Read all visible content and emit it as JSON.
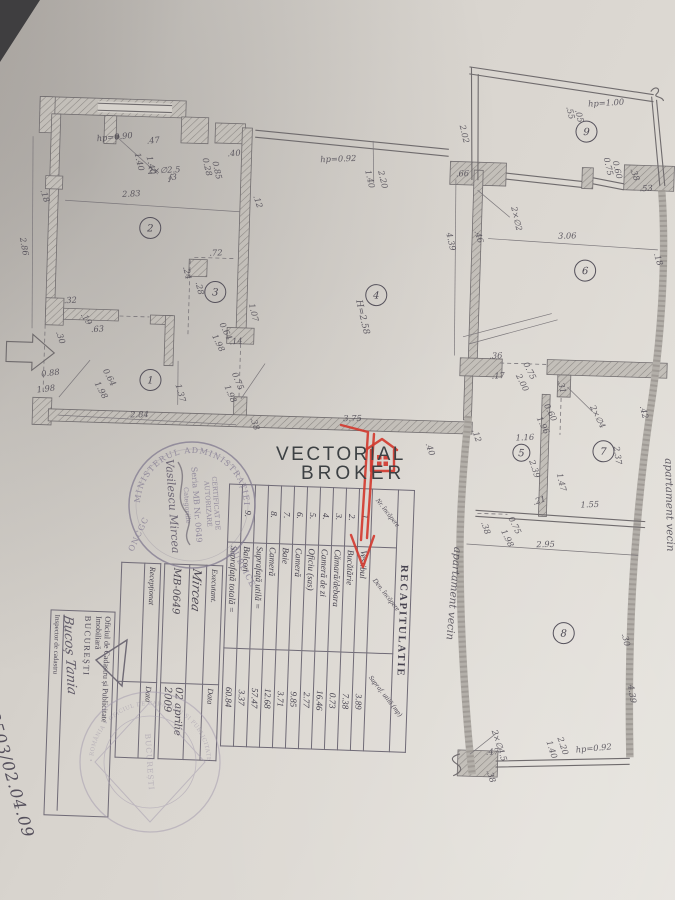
{
  "watermark": {
    "line1": "VECTORIAL",
    "line2": "BROKER"
  },
  "handwritten_number": "173503/02.04.09",
  "recapitulatie": {
    "title": "RECAPITULATIE",
    "col_nr": "Nr. încăpere",
    "col_den": "Den. încăpere",
    "col_supr": "Supraf. utilă (mp)",
    "rows": [
      {
        "nr": "1.",
        "name": "Vestibul",
        "val": "3.89"
      },
      {
        "nr": "2.",
        "name": "Bucătărie",
        "val": "7.38"
      },
      {
        "nr": "3.",
        "name": "Cămară/debara",
        "val": "0.73"
      },
      {
        "nr": "4.",
        "name": "Cameră de zi",
        "val": "16.46"
      },
      {
        "nr": "5.",
        "name": "Oficiu (sas)",
        "val": "2.77"
      },
      {
        "nr": "6.",
        "name": "Cameră",
        "val": "9.85"
      },
      {
        "nr": "7.",
        "name": "Baie",
        "val": "3.71"
      },
      {
        "nr": "8.",
        "name": "Cameră",
        "val": "12.68"
      },
      {
        "nr": "",
        "name": "Suprafață utilă =",
        "val": "57.47",
        "total": true
      },
      {
        "nr": "9.",
        "name": "Balcon",
        "val": "3.37"
      },
      {
        "nr": "",
        "name": "Suprafață totală =",
        "val": "60.84",
        "total": true
      }
    ]
  },
  "executant": {
    "label": "Executant.",
    "data_label": "Data",
    "signature": "Mircea",
    "value": "MB-0649",
    "date": "02 aprilie 2009",
    "receptionat_label": "Recepționat",
    "data_label2": "Data"
  },
  "oficiul": {
    "line1": "Oficiul de Cadastru și Publicitate",
    "line2": "Imobiliară",
    "city": "BUCUREȘTI",
    "inspector": "Inspector de cadastru",
    "signature": "Bucoș Tania"
  },
  "stamps": {
    "ministry": {
      "ring_top": "MINISTERUL ADMINISTRAȚIEI",
      "ring_right": "PUBLICE",
      "ring_left": "ONCGC",
      "line1": "CERTIFICAT DE",
      "line2": "AUTORIZARE",
      "line3": "Seria MB Nr. 0649",
      "line4": "Categoriile",
      "name": "Vasilescu Mircea"
    },
    "cadastru": {
      "ring": "• ROMÂNIA • OFICIUL DE CADASTRU ȘI PUBLICITATE IMOBILIARĂ •",
      "center": "BUCUREȘTI"
    }
  },
  "plan": {
    "labels": [
      {
        "t": ".47",
        "x": 138,
        "y": 150,
        "r": -8
      },
      {
        "t": "∮3",
        "x": 160,
        "y": 186,
        "r": -8
      },
      {
        "t": "hp=0.90",
        "x": 88,
        "y": 149,
        "r": -7
      },
      {
        "t": "1.40",
        "x": 126,
        "y": 160,
        "r": 75
      },
      {
        "t": "1.40",
        "x": 138,
        "y": 163,
        "r": 75
      },
      {
        "t": "2×∅2.5",
        "x": 140,
        "y": 180,
        "r": -5
      },
      {
        "t": "0.28",
        "x": 194,
        "y": 163,
        "r": 75
      },
      {
        "t": "0.85",
        "x": 204,
        "y": 166,
        "r": 75
      },
      {
        "t": ".40",
        "x": 219,
        "y": 160,
        "r": -5
      },
      {
        "t": "2.86",
        "x": 14,
        "y": 248,
        "r": 78
      },
      {
        "t": ".18",
        "x": 33,
        "y": 200,
        "r": 70
      },
      {
        "t": "2.83",
        "x": 115,
        "y": 204,
        "r": -5
      },
      {
        "t": ".12",
        "x": 246,
        "y": 199,
        "r": 70
      },
      {
        "t": ".72",
        "x": 204,
        "y": 260,
        "r": -4
      },
      {
        "t": ".24",
        "x": 178,
        "y": 272,
        "r": 75
      },
      {
        "t": ".28",
        "x": 191,
        "y": 287,
        "r": 75
      },
      {
        "t": "1.07",
        "x": 245,
        "y": 307,
        "r": 75
      },
      {
        "t": "0.64",
        "x": 216,
        "y": 328,
        "r": 62
      },
      {
        "t": "1.98",
        "x": 209,
        "y": 340,
        "r": 62
      },
      {
        "t": ".14",
        "x": 227,
        "y": 348,
        "r": -6
      },
      {
        "t": ".32",
        "x": 60,
        "y": 312,
        "r": -5
      },
      {
        "t": ".19",
        "x": 77,
        "y": 323,
        "r": 55
      },
      {
        "t": ".30",
        "x": 53,
        "y": 341,
        "r": 70
      },
      {
        "t": ".63",
        "x": 88,
        "y": 340,
        "r": -5
      },
      {
        "t": "0.64",
        "x": 101,
        "y": 378,
        "r": 60
      },
      {
        "t": "1.98",
        "x": 93,
        "y": 391,
        "r": 60
      },
      {
        "t": "0.88",
        "x": 40,
        "y": 386,
        "r": -8
      },
      {
        "t": "1.98",
        "x": 36,
        "y": 402,
        "r": -8
      },
      {
        "t": "1.37",
        "x": 174,
        "y": 390,
        "r": 72
      },
      {
        "t": "2.84",
        "x": 130,
        "y": 424,
        "r": -3
      },
      {
        "t": ".38",
        "x": 250,
        "y": 421,
        "r": 70
      },
      {
        "t": "0.75",
        "x": 230,
        "y": 377,
        "r": 65
      },
      {
        "t": "1.98",
        "x": 223,
        "y": 390,
        "r": 65
      },
      {
        "t": "3.75",
        "x": 343,
        "y": 421,
        "r": -2
      },
      {
        "t": ".40",
        "x": 426,
        "y": 441,
        "r": 70
      },
      {
        "t": ".12",
        "x": 472,
        "y": 426,
        "r": 70
      },
      {
        "t": "hp=0.92",
        "x": 312,
        "y": 163,
        "r": -4
      },
      {
        "t": "1.40",
        "x": 357,
        "y": 170,
        "r": 75
      },
      {
        "t": "2.20",
        "x": 370,
        "y": 170,
        "r": 75
      },
      {
        "t": ".66",
        "x": 448,
        "y": 173,
        "r": -4
      },
      {
        "t": "4.39",
        "x": 440,
        "y": 230,
        "r": 75
      },
      {
        "t": "H=2.58",
        "x": 352,
        "y": 300,
        "r": 75,
        "s": 9
      },
      {
        "t": "2.02",
        "x": 450,
        "y": 122,
        "r": 75
      },
      {
        "t": ".55",
        "x": 556,
        "y": 100,
        "r": 75
      },
      {
        "t": ".05",
        "x": 565,
        "y": 103,
        "r": 75
      },
      {
        "t": "hp=1.00",
        "x": 578,
        "y": 99,
        "r": -5
      },
      {
        "t": "0.75",
        "x": 595,
        "y": 150,
        "r": 75
      },
      {
        "t": "0.60",
        "x": 604,
        "y": 153,
        "r": 75
      },
      {
        "t": ".38",
        "x": 622,
        "y": 160,
        "r": 70
      },
      {
        "t": ".53",
        "x": 632,
        "y": 182,
        "r": -4
      },
      {
        "t": "2×∅2",
        "x": 504,
        "y": 202,
        "r": 75
      },
      {
        "t": ".46",
        "x": 468,
        "y": 227,
        "r": 70
      },
      {
        "t": "3.06",
        "x": 552,
        "y": 232,
        "r": -3
      },
      {
        "t": ".18",
        "x": 648,
        "y": 244,
        "r": 70
      },
      {
        "t": ".36",
        "x": 487,
        "y": 354,
        "r": -4
      },
      {
        "t": ".17",
        "x": 490,
        "y": 374,
        "r": -4
      },
      {
        "t": "0.75",
        "x": 521,
        "y": 358,
        "r": 62
      },
      {
        "t": "2.00",
        "x": 514,
        "y": 370,
        "r": 62
      },
      {
        "t": ".31",
        "x": 556,
        "y": 374,
        "r": 75
      },
      {
        "t": "0.60",
        "x": 543,
        "y": 399,
        "r": 62
      },
      {
        "t": "1.96",
        "x": 536,
        "y": 412,
        "r": 62
      },
      {
        "t": "2×∅4",
        "x": 589,
        "y": 399,
        "r": 62
      },
      {
        "t": ".42",
        "x": 639,
        "y": 397,
        "r": 75
      },
      {
        "t": "2.37",
        "x": 614,
        "y": 438,
        "r": 80
      },
      {
        "t": "1.16",
        "x": 516,
        "y": 435,
        "r": -4
      },
      {
        "t": "2.39",
        "x": 530,
        "y": 455,
        "r": 70
      },
      {
        "t": "1.47",
        "x": 558,
        "y": 467,
        "r": 75
      },
      {
        "t": "1.55",
        "x": 583,
        "y": 500,
        "r": -4
      },
      {
        "t": ".21",
        "x": 536,
        "y": 499,
        "r": -20
      },
      {
        "t": "0.75",
        "x": 511,
        "y": 513,
        "r": 62
      },
      {
        "t": "1.98",
        "x": 504,
        "y": 526,
        "r": 62
      },
      {
        "t": ".38",
        "x": 484,
        "y": 518,
        "r": 70
      },
      {
        "t": "2.95",
        "x": 540,
        "y": 541,
        "r": -3
      },
      {
        "t": "4.39",
        "x": 636,
        "y": 676,
        "r": 80
      },
      {
        "t": ".30",
        "x": 628,
        "y": 625,
        "r": 75
      },
      {
        "t": "2×∅4.5",
        "x": 501,
        "y": 726,
        "r": 70
      },
      {
        "t": ".47",
        "x": 496,
        "y": 750,
        "r": -4
      },
      {
        "t": ".38",
        "x": 497,
        "y": 766,
        "r": 70
      },
      {
        "t": "1.40",
        "x": 556,
        "y": 735,
        "r": 70
      },
      {
        "t": "2.20",
        "x": 567,
        "y": 731,
        "r": 70
      },
      {
        "t": "hp=0.92",
        "x": 586,
        "y": 745,
        "r": -7
      },
      {
        "t": "apartament vecin",
        "x": 458,
        "y": 543,
        "r": 93,
        "s": 10.5
      },
      {
        "t": "apartament vecin",
        "x": 666,
        "y": 448,
        "r": 87,
        "s": 10.5
      }
    ],
    "rooms": [
      {
        "n": "1",
        "x": 149,
        "y": 386
      },
      {
        "n": "2",
        "x": 144,
        "y": 234
      },
      {
        "n": "3",
        "x": 211,
        "y": 296
      },
      {
        "n": "4",
        "x": 372,
        "y": 294
      },
      {
        "n": "5",
        "x": 522,
        "y": 447,
        "cr": 8.5
      },
      {
        "n": "6",
        "x": 580,
        "y": 263
      },
      {
        "n": "7",
        "x": 604,
        "y": 443
      },
      {
        "n": "8",
        "x": 570,
        "y": 626
      },
      {
        "n": "9",
        "x": 577,
        "y": 124
      }
    ]
  }
}
